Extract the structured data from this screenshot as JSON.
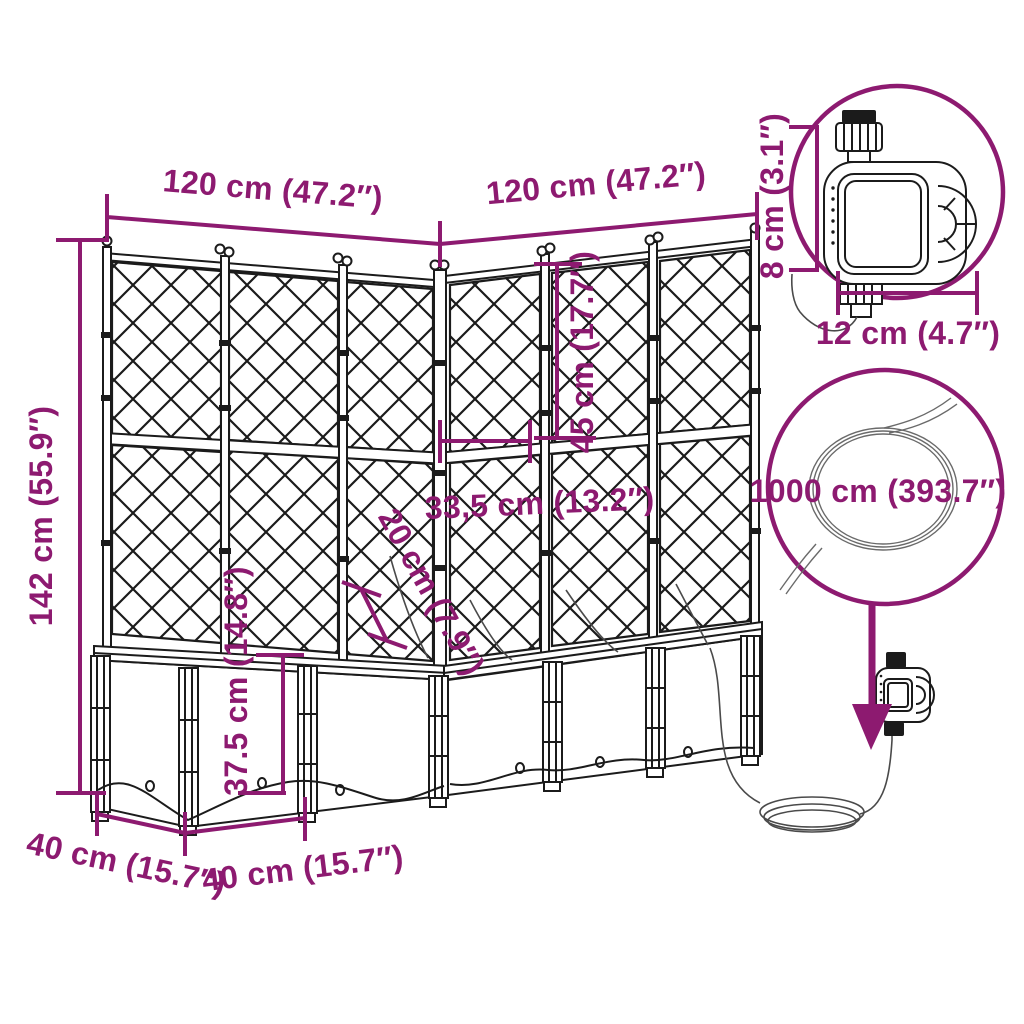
{
  "labels": {
    "width_left": "120 cm (47.2″)",
    "width_right": "120 cm (47.2″)",
    "total_height": "142 cm (55.9″)",
    "trellis_upper_height": "45 cm (17.7″)",
    "corner_inner_width": "33,5 cm (13.2″)",
    "rim_depth": "20 cm (7.9″)",
    "box_height": "37.5 cm (14.8″)",
    "base_depth": "40 cm (15.7″)",
    "module_width": "40 cm (15.7″)",
    "timer_height": "8 cm (3.1″)",
    "timer_width": "12 cm (4.7″)",
    "hose_length": "1000 cm (393.7″)"
  },
  "colors": {
    "annotation": "#8d1a70",
    "lineart": "#1b1b1b"
  }
}
